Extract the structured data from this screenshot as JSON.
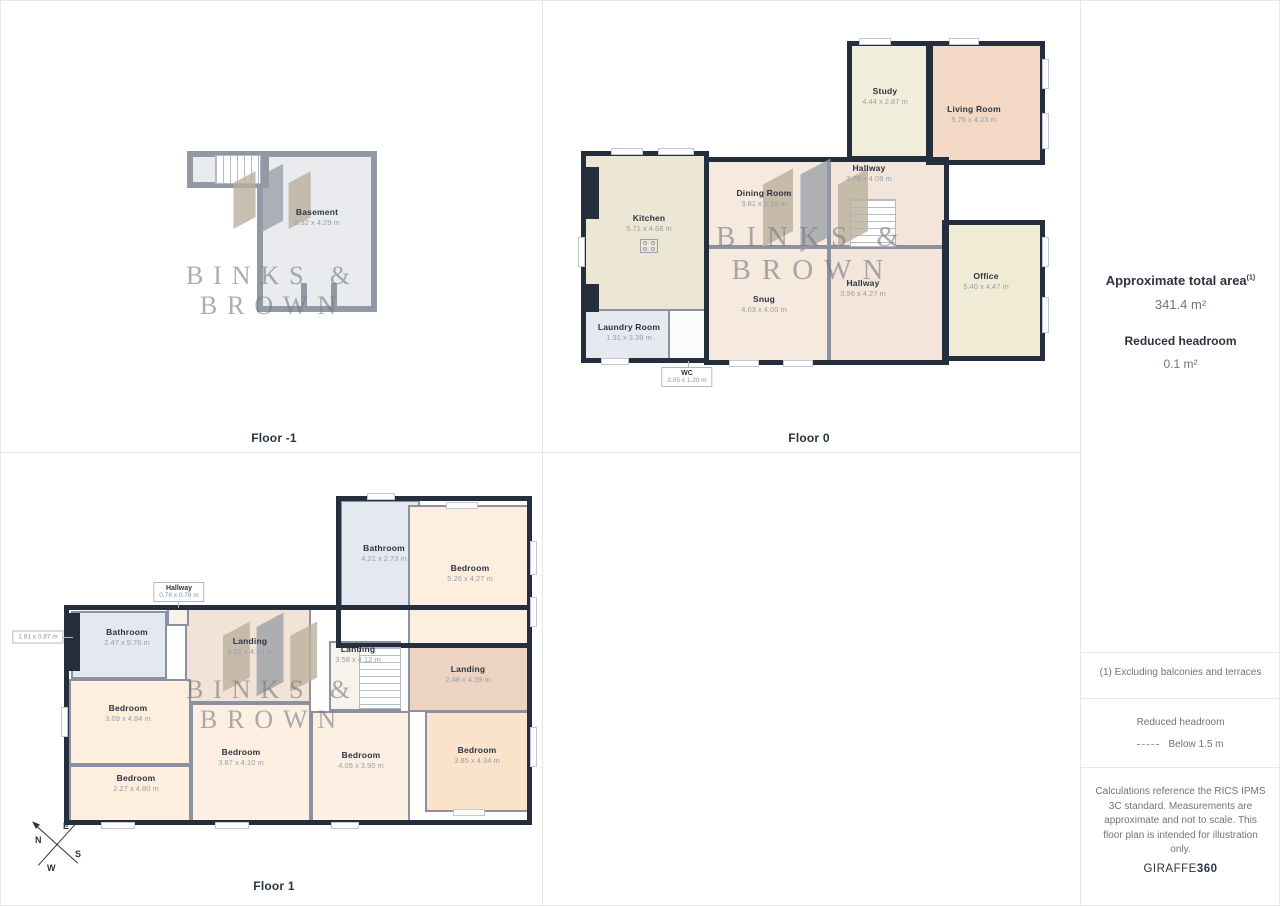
{
  "colors": {
    "wall_dark": "#242e3d",
    "wall_outer_gray": "#9298a4",
    "wall_interior": "#8b91a0",
    "stair_line": "#b6bcc6",
    "text_dark": "#2b3440",
    "text_gray": "#6e7480",
    "dims_gray": "#9aa0a8",
    "divider": "#e7e8ea"
  },
  "watermark": {
    "line1": "BINKS &",
    "line2": "BROWN"
  },
  "compass": {
    "n": "N",
    "e": "E",
    "s": "S",
    "w": "W"
  },
  "floors": [
    {
      "label": "Floor -1",
      "wall": "gray",
      "blocks": [
        [
          186,
          150,
          82,
          37
        ],
        [
          256,
          150,
          120,
          161
        ]
      ],
      "rooms": [
        {
          "name": "Basement",
          "dims": "5.32 x 4.29 m",
          "r": [
            256,
            150,
            120,
            161
          ],
          "bg": "#e9ebee",
          "lp": [
            316,
            216
          ]
        },
        {
          "r": [
            186,
            150,
            82,
            37
          ],
          "bg": "#e9ebee"
        }
      ],
      "stairs": [
        [
          214,
          154,
          46,
          29,
          "v"
        ]
      ],
      "patches": [
        [
          300,
          282,
          6,
          29
        ],
        [
          330,
          282,
          6,
          29
        ]
      ],
      "windows": []
    },
    {
      "label": "Floor 0",
      "wall": "dark",
      "blocks": [
        [
          580,
          150,
          128,
          212
        ],
        [
          703,
          156,
          245,
          208
        ],
        [
          846,
          40,
          86,
          120
        ],
        [
          925,
          40,
          119,
          124
        ],
        [
          941,
          219,
          103,
          141
        ]
      ],
      "rooms": [
        {
          "name": "Kitchen",
          "dims": "5.71 x 4.68 m",
          "r": [
            583,
            153,
            122,
            157
          ],
          "bg": "#ece7d4",
          "lp": [
            648,
            222
          ]
        },
        {
          "name": "Laundry Room",
          "dims": "1.31 x 3.39 m",
          "r": [
            583,
            308,
            86,
            52
          ],
          "bg": "#e6e9f0",
          "lp": [
            628,
            331
          ]
        },
        {
          "r": [
            667,
            308,
            38,
            52
          ],
          "bg": "#fcfcfd"
        },
        {
          "name": "Dining Room",
          "dims": "3.81 x 5.16 m",
          "r": [
            706,
            159,
            122,
            87
          ],
          "bg": "#f6e9dd",
          "lp": [
            763,
            197
          ]
        },
        {
          "name": "Snug",
          "dims": "4.03 x 4.00 m",
          "r": [
            706,
            246,
            122,
            116
          ],
          "bg": "#f6e9dd",
          "lp": [
            763,
            303
          ]
        },
        {
          "name": "Hallway",
          "dims": "3.78 x 4.09 m",
          "r": [
            828,
            159,
            117,
            87
          ],
          "bg": "#f3e5d9",
          "lp": [
            868,
            172
          ]
        },
        {
          "name": "Hallway",
          "dims": "3.96 x 4.27 m",
          "r": [
            828,
            246,
            117,
            116
          ],
          "bg": "#f3e5d9",
          "lp": [
            862,
            287
          ]
        },
        {
          "name": "Study",
          "dims": "4.44 x 2.87 m",
          "r": [
            849,
            43,
            80,
            114
          ],
          "bg": "#f1eedb",
          "lp": [
            884,
            95
          ]
        },
        {
          "name": "Living Room",
          "dims": "5.76 x 4.23 m",
          "r": [
            927,
            43,
            115,
            119
          ],
          "bg": "#f3d8c6",
          "lp": [
            973,
            113
          ]
        },
        {
          "name": "Office",
          "dims": "5.40 x 4.47 m",
          "r": [
            944,
            222,
            99,
            136
          ],
          "bg": "#f0ebd5",
          "lp": [
            985,
            280
          ]
        }
      ],
      "stairs": [
        [
          849,
          198,
          46,
          48,
          "h"
        ]
      ],
      "patches": [
        [
          583,
          166,
          15,
          52
        ],
        [
          583,
          283,
          15,
          28
        ]
      ],
      "windows": [
        [
          577,
          236,
          7,
          30
        ],
        [
          610,
          147,
          32,
          7
        ],
        [
          657,
          147,
          36,
          7
        ],
        [
          858,
          37,
          32,
          7
        ],
        [
          948,
          37,
          30,
          7
        ],
        [
          1041,
          58,
          7,
          30
        ],
        [
          1041,
          112,
          7,
          36
        ],
        [
          1041,
          236,
          7,
          30
        ],
        [
          1041,
          296,
          7,
          36
        ],
        [
          728,
          359,
          30,
          7
        ],
        [
          782,
          359,
          30,
          7
        ],
        [
          600,
          357,
          28,
          7
        ]
      ],
      "callouts": [
        {
          "lines": [
            "WC",
            "2.05 x 1.20 m"
          ],
          "cp": [
            686,
            376
          ],
          "leader": [
            687,
            360,
            1,
            8
          ]
        }
      ]
    },
    {
      "label": "Floor 1",
      "wall": "dark",
      "blocks": [
        [
          335,
          495,
          196,
          152
        ],
        [
          63,
          604,
          468,
          220
        ]
      ],
      "rooms": [
        {
          "name": "Bathroom",
          "dims": "4.21 x 2.73 m",
          "r": [
            339,
            499,
            80,
            108
          ],
          "bg": "#e4e8f0",
          "lp": [
            383,
            552
          ]
        },
        {
          "name": "Bedroom",
          "dims": "5.26 x 4.27 m",
          "r": [
            407,
            504,
            121,
            141
          ],
          "bg": "#fdeedd",
          "lp": [
            469,
            572
          ]
        },
        {
          "name": "Bathroom",
          "dims": "2.47 x 5.76 m",
          "r": [
            70,
            610,
            96,
            68
          ],
          "bg": "#e4e8f0",
          "lp": [
            126,
            636
          ]
        },
        {
          "name": "Landing",
          "dims": "3.62 x 4.19 m",
          "r": [
            184,
            607,
            126,
            95
          ],
          "bg": "#f2e3d6",
          "lp": [
            249,
            645
          ]
        },
        {
          "name": "Landing",
          "dims": "3.58 x 4.12 m",
          "r": [
            328,
            640,
            72,
            70
          ],
          "bg": "#f8f3ea",
          "lp": [
            357,
            653
          ]
        },
        {
          "name": "Landing",
          "dims": "2.48 x 4.39 m",
          "r": [
            407,
            645,
            121,
            66
          ],
          "bg": "#edd4c2",
          "lp": [
            467,
            673
          ]
        },
        {
          "name": "Bedroom",
          "dims": "3.09 x 4.84 m",
          "r": [
            68,
            678,
            122,
            86
          ],
          "bg": "#fdeedd",
          "lp": [
            127,
            712
          ]
        },
        {
          "name": "Bedroom",
          "dims": "2.27 x 4.80 m",
          "r": [
            68,
            764,
            122,
            57
          ],
          "bg": "#fdeedd",
          "lp": [
            135,
            782
          ]
        },
        {
          "name": "Bedroom",
          "dims": "3.87 x 4.10 m",
          "r": [
            190,
            702,
            120,
            119
          ],
          "bg": "#fdf0e2",
          "lp": [
            240,
            756
          ]
        },
        {
          "name": "Bedroom",
          "dims": "4.05 x 3.90 m",
          "r": [
            310,
            710,
            99,
            111
          ],
          "bg": "#fdf0e2",
          "lp": [
            360,
            759
          ]
        },
        {
          "name": "Bedroom",
          "dims": "3.85 x 4.34 m",
          "r": [
            424,
            710,
            104,
            101
          ],
          "bg": "#fbe3cb",
          "lp": [
            476,
            754
          ]
        },
        {
          "r": [
            166,
            607,
            22,
            18
          ],
          "bg": "#f8f3ea"
        }
      ],
      "stairs": [
        [
          358,
          646,
          42,
          62,
          "h"
        ]
      ],
      "patches": [
        [
          65,
          612,
          14,
          58
        ]
      ],
      "windows": [
        [
          366,
          492,
          28,
          7
        ],
        [
          445,
          501,
          32,
          7
        ],
        [
          529,
          540,
          7,
          34
        ],
        [
          529,
          596,
          7,
          30
        ],
        [
          529,
          726,
          7,
          40
        ],
        [
          60,
          706,
          7,
          30
        ],
        [
          100,
          821,
          34,
          7
        ],
        [
          214,
          821,
          34,
          7
        ],
        [
          330,
          821,
          28,
          7
        ],
        [
          452,
          808,
          32,
          7
        ]
      ],
      "callouts": [
        {
          "lines": [
            "Hallway",
            "0.78 x 0.78 m"
          ],
          "cp": [
            178,
            591
          ],
          "leader": [
            177,
            601,
            1,
            6
          ]
        },
        {
          "lines": [
            "1.81 x 0.87 m"
          ],
          "cp": [
            37,
            636
          ],
          "leader": [
            60,
            636,
            12,
            1
          ]
        }
      ]
    }
  ],
  "sidebar": {
    "total_area_label": "Approximate total area",
    "total_area_sup": "(1)",
    "total_area_value": "341.4 m²",
    "reduced_headroom_label": "Reduced headroom",
    "reduced_headroom_value": "0.1 m²",
    "note1": "(1) Excluding balconies and terraces",
    "legend_title": "Reduced headroom",
    "legend_value": "Below 1.5 m",
    "disclaimer": "Calculations reference the RICS IPMS 3C standard. Measurements are approximate and not to scale. This floor plan is intended for illustration only.",
    "brand": "GIRAFFE",
    "brand_bold": "360"
  }
}
